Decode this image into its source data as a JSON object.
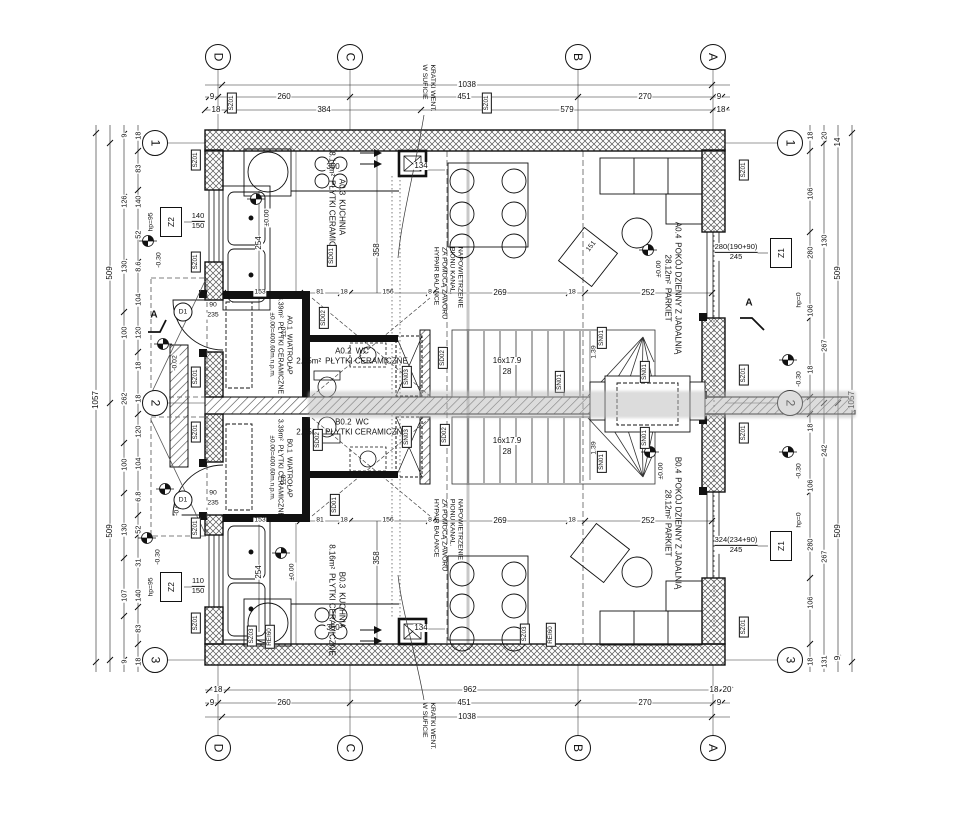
{
  "axes": {
    "top": [
      "D",
      "C",
      "B",
      "A"
    ],
    "bottom": [
      "D",
      "C",
      "B",
      "A"
    ],
    "left": [
      "1",
      "2",
      "3"
    ],
    "right": [
      "1",
      "2",
      "3"
    ]
  },
  "notes": {
    "vent": "KRATKI WENT.\nW SUFICIE",
    "aeration": "NAPOWIETRZENIE\nPIONU KANAL.\nZA POMOCĄ ZAWORU\nHYPAIR BALANCE"
  },
  "rooms": {
    "a1": {
      "id": "A0.1",
      "name": "WIATROŁAP",
      "area": "3.39m²",
      "floor": "PŁYTKI CERAMICZNE",
      "level": "±0.00=400.60m.n.p.m."
    },
    "a2": {
      "id": "A0.2",
      "name": "WC",
      "area": "2.05m²",
      "floor": "PŁYTKI CERAMICZNE"
    },
    "a3": {
      "id": "A0.3",
      "name": "KUCHNIA",
      "area": "8.16m²",
      "floor": "PŁYTKI CERAMICZNE"
    },
    "a4": {
      "id": "A0.4",
      "name": "POKÓJ DZIENNY Z JADALNIĄ",
      "area": "28.12m²",
      "floor": "PARKIET"
    },
    "b1": {
      "id": "B0.1",
      "name": "WIATROŁAP",
      "area": "3.39m²",
      "floor": "PŁYTKI CERAMICZNE",
      "level": "±0.00=400.60m.n.p.m."
    },
    "b2": {
      "id": "B0.2",
      "name": "WC",
      "area": "2.05m²",
      "floor": "PŁYTKI CERAMICZNE"
    },
    "b3": {
      "id": "B0.3",
      "name": "KUCHNIA",
      "area": "8.16m²",
      "floor": "PŁYTKI CERAMICZNE"
    },
    "b4": {
      "id": "B0.4",
      "name": "POKÓJ DZIENNY Z JADALNIĄ",
      "area": "28.12m²",
      "floor": "PARKIET"
    }
  },
  "windows": {
    "z2a": {
      "code": "Z2",
      "num": "140",
      "den": "150",
      "hp": "hp=95"
    },
    "z2b": {
      "code": "Z2",
      "num": "110",
      "den": "150",
      "hp": "hp=95"
    },
    "z1a": {
      "code": "Z1",
      "num": "280(190+90)",
      "den": "245",
      "hp": "hp=0"
    },
    "z1b": {
      "code": "Z1",
      "num": "324(234+90)",
      "den": "245",
      "hp": "hp=0"
    }
  },
  "doors": {
    "code": "D1",
    "w": "90",
    "h": "235"
  },
  "levels": {
    "zero": "±0.00",
    "m30": "-0.30",
    "m02": "-0.02"
  },
  "stairs": {
    "run": "16x17.9",
    "width": "28"
  },
  "markers": {
    "sz01": "SZ01",
    "sz03": "SZ03",
    "sd01": "SD01",
    "sd02": "SD02",
    "sn01": "SN01",
    "sn03": "SN03",
    "rei60": "REI60"
  },
  "section": {
    "label": "A"
  },
  "dims": {
    "top": {
      "total": "1038",
      "r2": [
        "9",
        "260",
        "451",
        "270",
        "9"
      ],
      "r3": [
        "18",
        "384",
        "579",
        "18"
      ]
    },
    "bottom": {
      "r1": [
        "18",
        "962",
        "18",
        "20"
      ],
      "r2": [
        "9",
        "260",
        "451",
        "270",
        "9"
      ],
      "total": "1038"
    },
    "left": {
      "total": "1057",
      "outer": [
        "509",
        "509"
      ],
      "mid": [
        "9",
        "126",
        "130",
        "100",
        "262",
        "100",
        "130",
        "107",
        "9"
      ],
      "inner": [
        "18",
        "83",
        "140",
        "52",
        "8.6",
        "104",
        "120",
        "18",
        "18",
        "120",
        "104",
        "6.8",
        "52",
        "31",
        "140",
        "83",
        "18"
      ]
    },
    "right": {
      "total": "1057",
      "outer": [
        "14",
        "509",
        "509",
        "9"
      ],
      "mid": [
        "20",
        "130",
        "267",
        "242",
        "267",
        "131"
      ],
      "inner": [
        "18",
        "106",
        "280",
        "106",
        "18",
        "18",
        "106",
        "280",
        "106",
        "18"
      ]
    },
    "row_top": [
      "153",
      "81",
      "18",
      "156",
      "8",
      "269",
      "18",
      "252"
    ],
    "row_bottom": [
      "153",
      "81",
      "18",
      "156",
      "8",
      "269",
      "18",
      "252"
    ],
    "misc": {
      "d358": "358",
      "d254": "254",
      "d350": "350",
      "d134": "134",
      "d110": "110",
      "d139": "1.39",
      "d151": "151"
    }
  }
}
